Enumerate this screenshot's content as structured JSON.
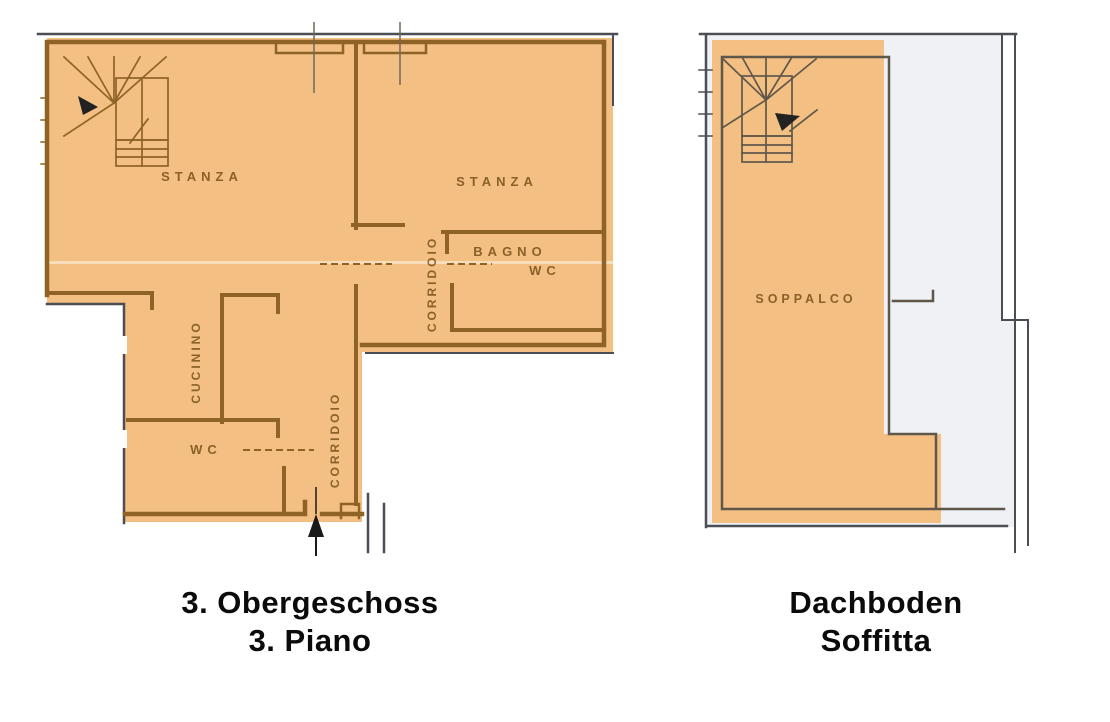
{
  "colors": {
    "background": "#ffffff",
    "highlight": "#f4bf82",
    "plan_wall": "#8f6326",
    "label_color": "#8a6128",
    "scan_edge": "#4a4f55",
    "attic_wall": "#5f584a",
    "attic_floor": "#eff1f4",
    "caption_color": "#0b0b0b"
  },
  "left_plan": {
    "caption_line1": "3. Obergeschoss",
    "caption_line2": "3. Piano",
    "labels": {
      "stanza_left": "STANZA",
      "stanza_right": "STANZA",
      "bagno": "BAGNO",
      "bagno_wc": "WC",
      "corridoio_upper": "CORRIDOIO",
      "cucinino": "CUCININO",
      "wc": "WC",
      "corridoio_lower": "CORRIDOIO"
    }
  },
  "right_plan": {
    "caption_line1": "Dachboden",
    "caption_line2": "Soffitta",
    "labels": {
      "soppalco": "SOPPALCO"
    }
  }
}
